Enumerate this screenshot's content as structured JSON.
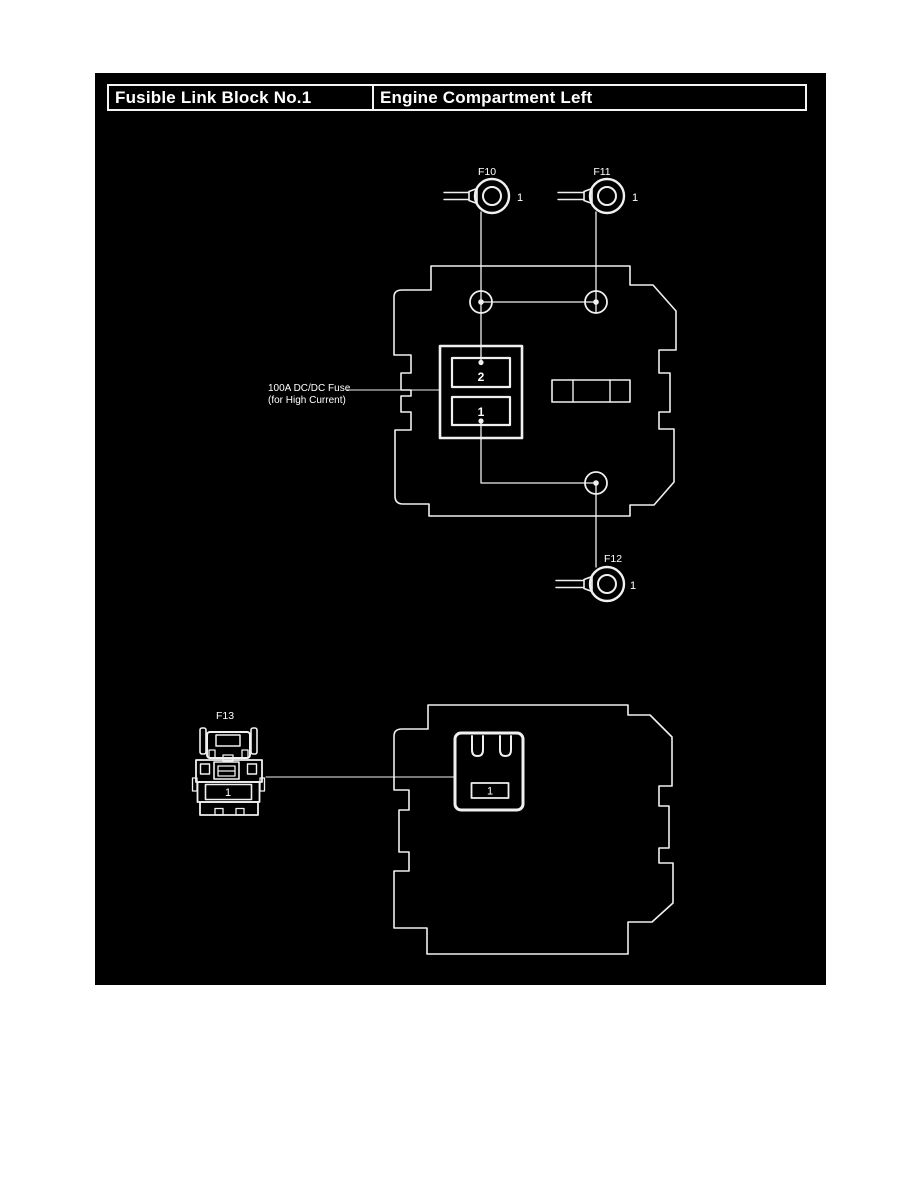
{
  "colors": {
    "page_bg": "#ffffff",
    "panel_bg": "#000000",
    "line": "#f0f0f0",
    "text": "#ffffff"
  },
  "header": {
    "left": "Fusible Link Block No.1",
    "right": "Engine Compartment Left"
  },
  "upper": {
    "f10": {
      "label": "F10",
      "pin": "1"
    },
    "f11": {
      "label": "F11",
      "pin": "1"
    },
    "f12": {
      "label": "F12",
      "pin": "1"
    },
    "fuse_note": {
      "line1": "100A DC/DC Fuse",
      "line2": "(for High Current)"
    },
    "holder": {
      "slot_top": "2",
      "slot_bottom": "1"
    }
  },
  "lower": {
    "f13": {
      "label": "F13",
      "pin": "1"
    },
    "socket": {
      "pin": "1"
    }
  }
}
